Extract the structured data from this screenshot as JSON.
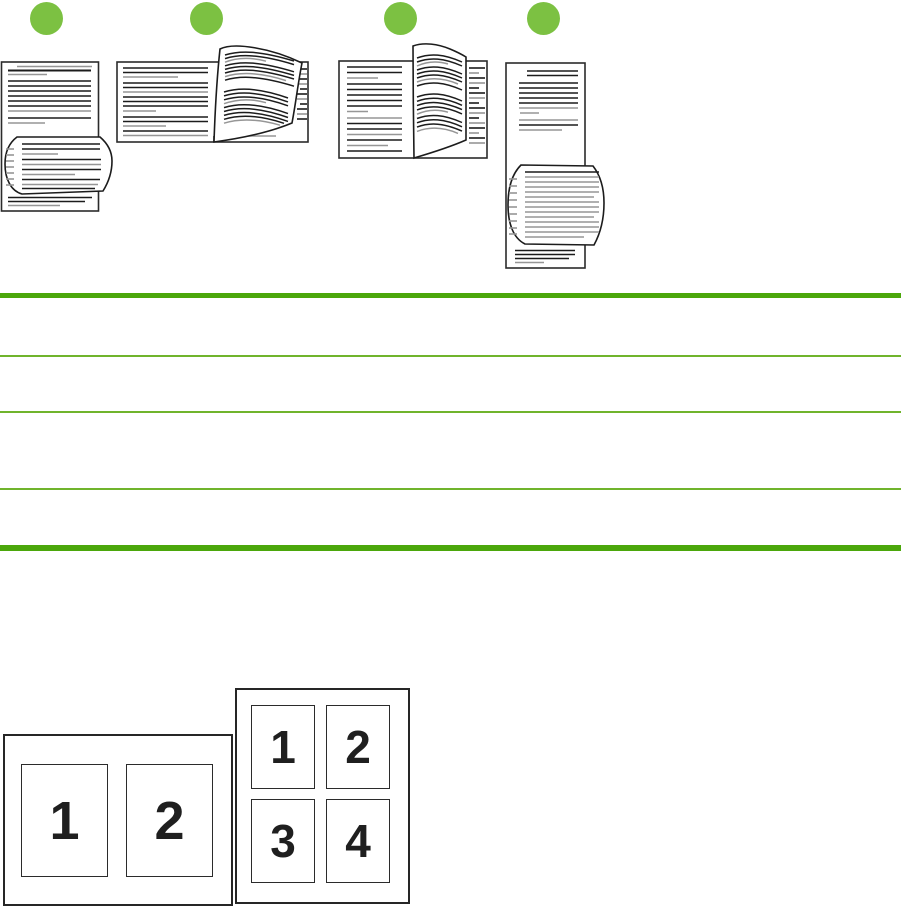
{
  "page": {
    "background": "#ffffff",
    "description_visible_text_only": true
  },
  "colors": {
    "step_circle_green": "#7cc142",
    "table_rule_thick_green": "#4ba70b",
    "table_rule_thin_green": "#70b42c",
    "line_art_dark": "#1c1c1c",
    "line_art_gray": "#969696",
    "number_black": "#1f1f1f"
  },
  "figure": {
    "step_marker_count": 4
  },
  "table": {
    "row_count": 4,
    "rows_empty": true
  },
  "nup": {
    "two_per_sheet": {
      "labels": [
        "1",
        "2"
      ]
    },
    "four_per_sheet": {
      "labels": [
        "1",
        "2",
        "3",
        "4"
      ]
    }
  }
}
